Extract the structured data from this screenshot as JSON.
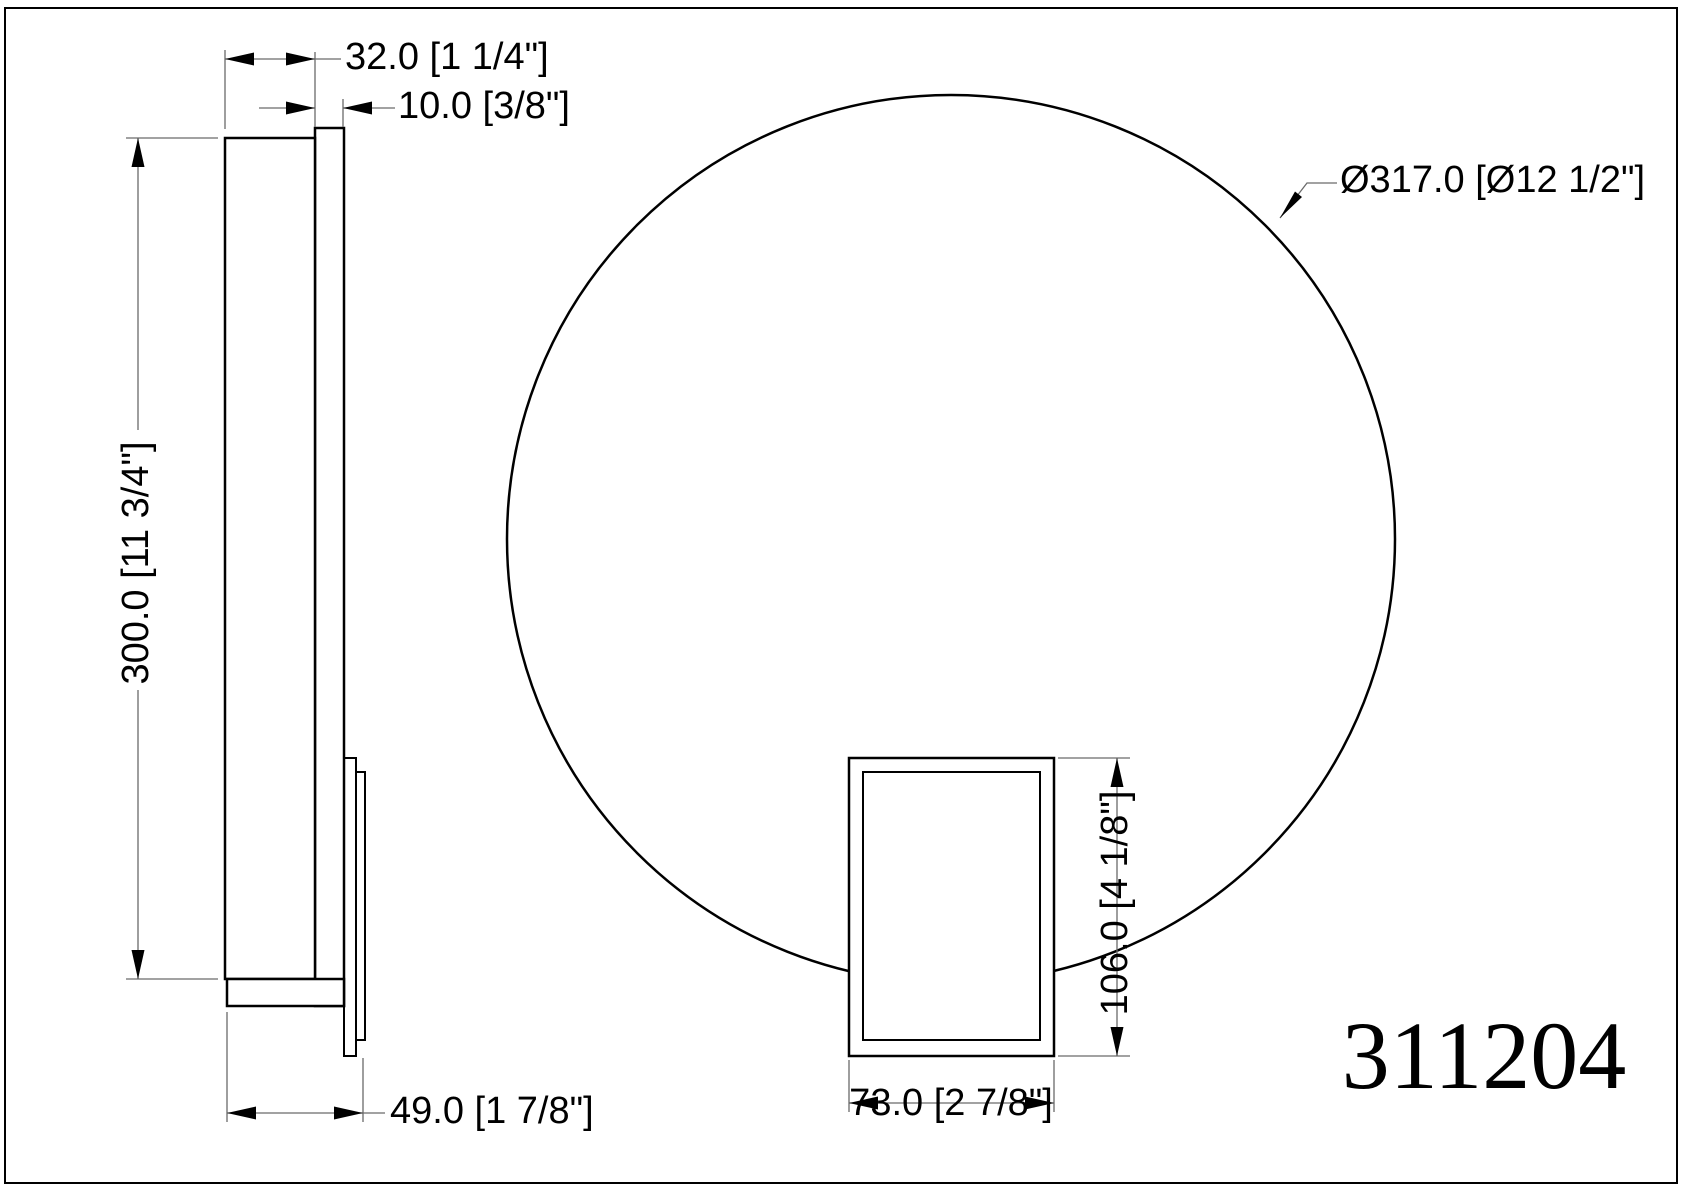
{
  "drawing": {
    "part_number": "311204",
    "labels": {
      "dim_depth": "32.0 [1 1/4\"]",
      "dim_plate": "10.0 [3/8\"]",
      "dim_height": "300.0 [11 3/4\"]",
      "dim_diameter": "Ø317.0 [Ø12 1/2\"]",
      "dim_box_height": "106.0 [4 1/8\"]",
      "dim_box_width": "73.0 [2 7/8\"]",
      "dim_total_depth": "49.0 [1 7/8\"]"
    },
    "colors": {
      "object_line": "#000000",
      "dimension_line": "#6a6a6a",
      "background": "#ffffff"
    }
  }
}
